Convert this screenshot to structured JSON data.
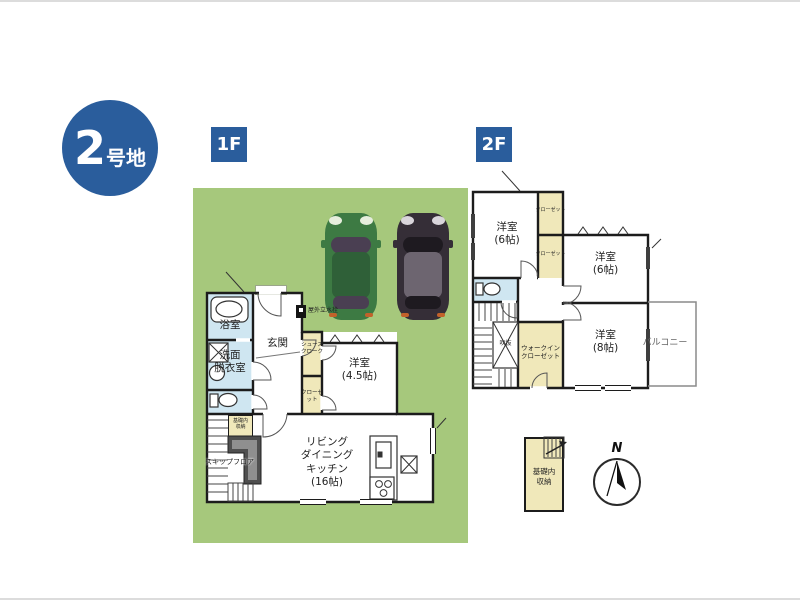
{
  "lot_badge": {
    "number": "2",
    "suffix": "号地"
  },
  "floor_labels": {
    "f1": "1F",
    "f2": "2F"
  },
  "floor1": {
    "bath": "浴室",
    "wash1": "洗面",
    "wash2": "脱衣室",
    "entrance": "玄関",
    "shoes1": "シューズ",
    "shoes2": "クローク",
    "closet": "クローゼット",
    "west1": "洋室",
    "west2": "(4.5帖)",
    "ldk1": "リビング",
    "ldk2": "ダイニング",
    "ldk3": "キッチン",
    "ldk4": "(16帖)",
    "skip": "スキップフロア",
    "kiso1": "基礎内",
    "kiso2": "収納",
    "faucet": "屋外立水栓"
  },
  "floor2": {
    "west6a1": "洋室",
    "west6a2": "(6帖)",
    "west6b1": "洋室",
    "west6b2": "(6帖)",
    "west81": "洋室",
    "west82": "(8帖)",
    "closet_top": "クローゼット",
    "closet_mid": "クローゼット",
    "wic1": "ウォークイン",
    "wic2": "クローゼット",
    "void": "吹抜",
    "balcony": "バルコニー"
  },
  "annex": {
    "kiso1": "基礎内",
    "kiso2": "収納"
  },
  "compass": {
    "north": "N"
  },
  "colors": {
    "brand_blue": "#2a5d9c",
    "lot_green": "#a6c87c",
    "wet_room_blue": "#cfe6f1",
    "closet_yellow": "#f0e8ba",
    "wall_black": "#1c1c1c",
    "skip_floor_gray": "#4f4f4f",
    "car_green": "#3d7a43",
    "car_black": "#352e37"
  }
}
